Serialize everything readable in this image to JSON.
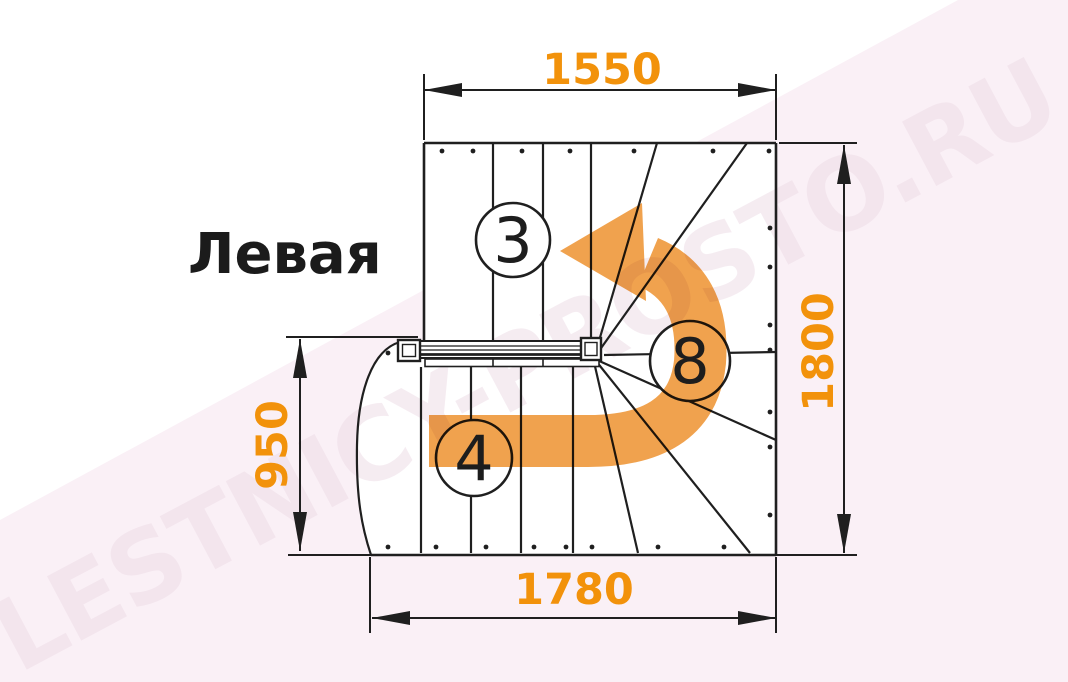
{
  "diagram": {
    "title": "Левая",
    "watermark": "LESTNICY-PROSTO.RU",
    "dimensions": {
      "top": "1550",
      "right": "1800",
      "left": "950",
      "bottom": "1780"
    },
    "step_counts": {
      "upper_flight": "3",
      "winders": "8",
      "lower_flight": "4"
    },
    "colors": {
      "dimension_orange": "#F2920B",
      "arrow_orange": "#F0A24E",
      "line_black": "#1F1F1F",
      "background_tint": "#FAF0F6",
      "watermark_tint": "#EEDDE7"
    }
  }
}
